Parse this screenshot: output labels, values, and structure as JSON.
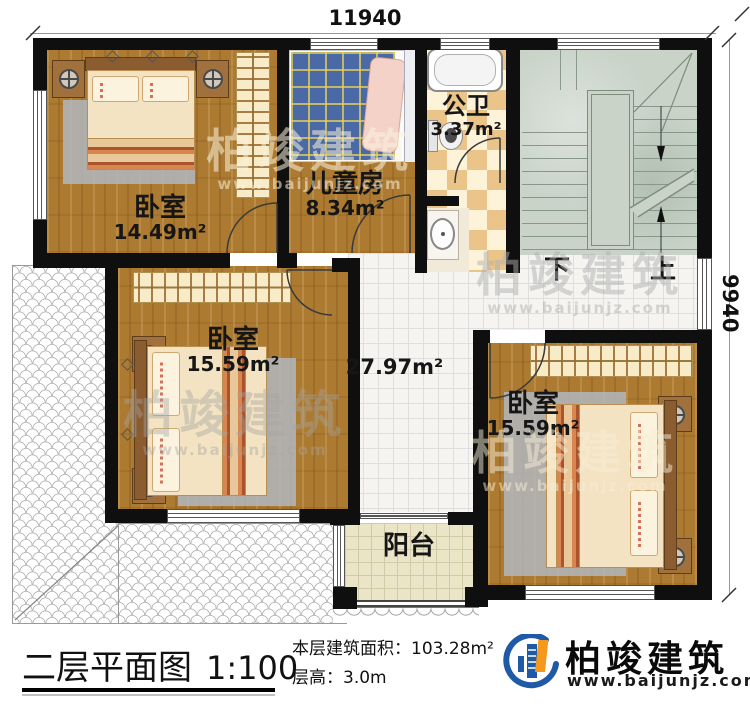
{
  "dimensions": {
    "top_width": "11940",
    "right_height": "9940"
  },
  "rooms": {
    "bedroom_top_left": {
      "label": "卧室",
      "area": "14.49m²"
    },
    "kids_room": {
      "label": "儿童房",
      "area": "8.34m²"
    },
    "bathroom": {
      "label": "公卫",
      "area": "3.37m²"
    },
    "bedroom_left": {
      "label": "卧室",
      "area": "15.59m²"
    },
    "bedroom_right": {
      "label": "卧室",
      "area": "15.59m²"
    },
    "hall": {
      "area": "27.97m²"
    },
    "balcony": {
      "label": "阳台"
    }
  },
  "stairs": {
    "down_label": "下",
    "up_label": "上"
  },
  "title_block": {
    "title": "二层平面图",
    "scale": "1:100",
    "floor_area_label": "本层建筑面积：",
    "floor_area_value": "103.28m²",
    "floor_height_label": "层高：",
    "floor_height_value": "3.0m"
  },
  "brand": {
    "name": "柏竣建筑",
    "website": "www.baijunjz.com"
  },
  "watermark": {
    "name": "柏竣建筑",
    "website": "www.baijunjz.com"
  },
  "colors": {
    "wall": "#0f0f0f",
    "wood_floor": "#ac7a30",
    "hall_tile": "#f5f4f0",
    "stair_floor": "#c9d3c8",
    "balcony_tile": "#ebe5c8",
    "bathroom_checker_dark": "#eac489",
    "bathroom_checker_light": "#fdf3d8",
    "kids_bed_blue": "#4b69a4",
    "brand_blue": "#1e5aa6",
    "brand_orange": "#f5991c"
  }
}
